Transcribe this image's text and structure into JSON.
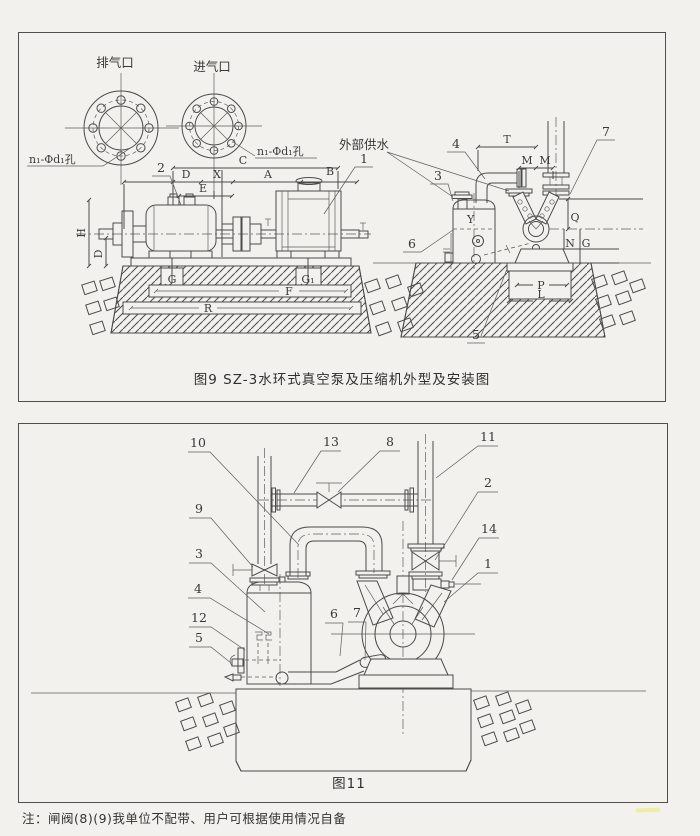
{
  "colors": {
    "paper": "#f2f1ed",
    "ink": "#4a4a4a"
  },
  "note": "注：闸阀(8)(9)我单位不配带、用户可根据使用情况自备",
  "fig9": {
    "caption": "图9 SZ-3水环式真空泵及压缩机外型及安装图",
    "port_labels": {
      "exhaust": "排气口",
      "intake": "进气口"
    },
    "bolt_note_left": "n₁-Φd₁孔",
    "bolt_note_right": "n₁-Φd₁孔",
    "water_supply": "外部供水",
    "dims": {
      "C": "C",
      "D": "D",
      "X": "X",
      "A": "A",
      "B": "B",
      "E": "E",
      "H": "H",
      "D2": "D",
      "G": "G",
      "G1": "G₁",
      "F": "F",
      "R": "R",
      "T": "T",
      "M1": "M",
      "M2": "M",
      "Q": "Q",
      "N": "N",
      "G2": "G",
      "P": "P",
      "L": "L",
      "Y": "Y"
    },
    "callouts": {
      "n1": "1",
      "n2": "2",
      "n3": "3",
      "n4": "4",
      "n5": "5",
      "n6": "6",
      "n7": "7"
    }
  },
  "fig11": {
    "caption": "图11",
    "callouts": {
      "n1": "1",
      "n2": "2",
      "n3": "3",
      "n4": "4",
      "n5": "5",
      "n6": "6",
      "n7": "7",
      "n8": "8",
      "n9": "9",
      "n10": "10",
      "n11": "11",
      "n12": "12",
      "n13": "13",
      "n14": "14"
    }
  }
}
